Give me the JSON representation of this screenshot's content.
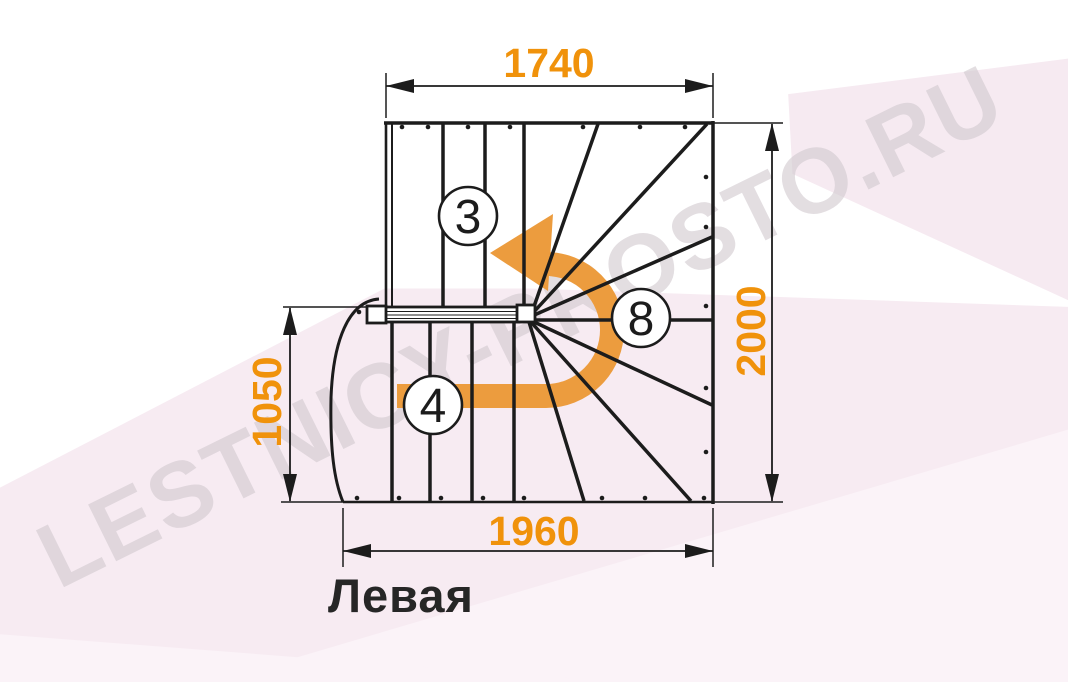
{
  "diagram": {
    "title_label": "Левая",
    "watermark": "LESTNICY-PROSTO.RU",
    "dimensions": {
      "top_width": "1740",
      "total_depth": "2000",
      "lower_flight_depth": "1050",
      "bottom_width": "1960"
    },
    "step_counts": {
      "upper_flight": "3",
      "winder": "8",
      "lower_flight": "4"
    },
    "colors": {
      "line": "#1c1c1c",
      "dimension_text": "#F0920B",
      "turn_arrow": "#EC9C3E",
      "label_text": "#262626",
      "background_tint": "#f7ebf2",
      "watermark_color": "#d2cad0"
    }
  }
}
